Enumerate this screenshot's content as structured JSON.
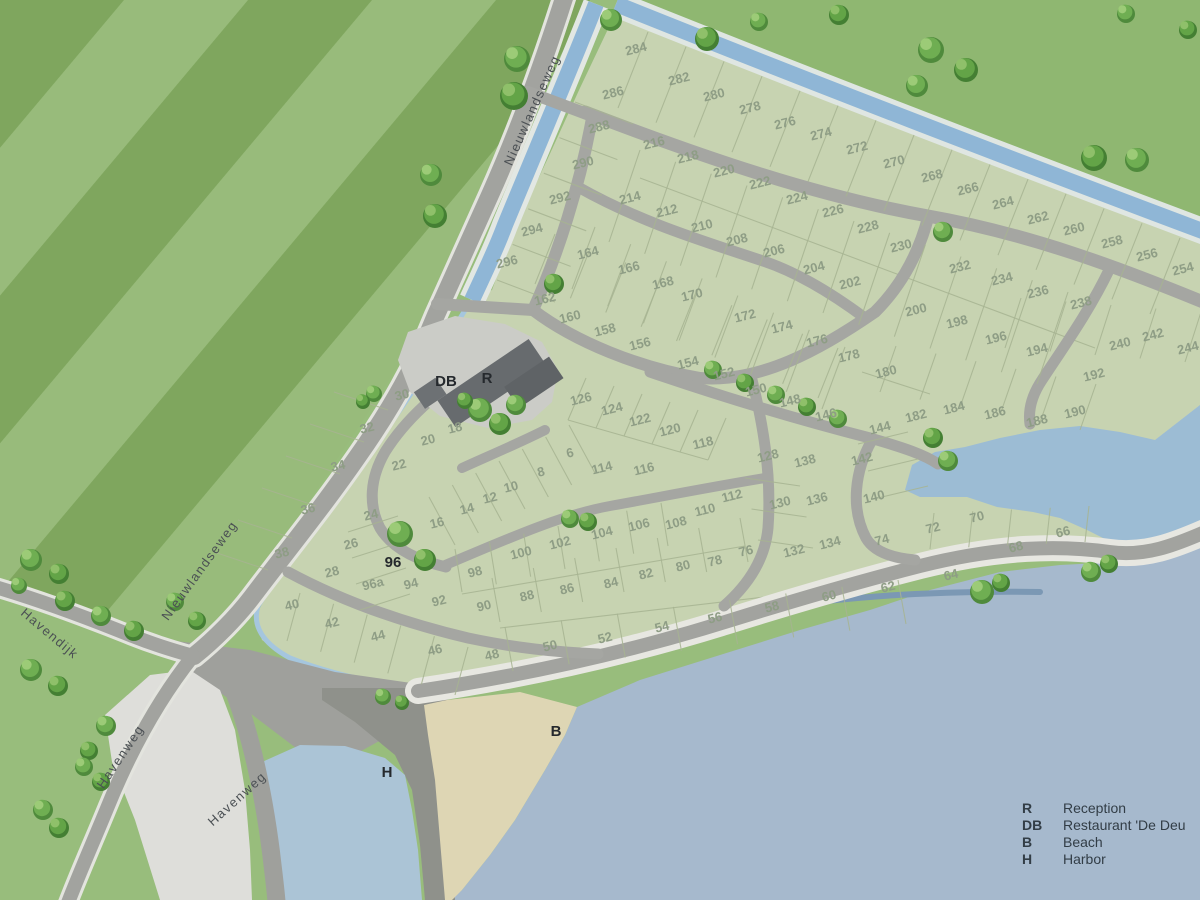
{
  "title": "Holiday park site map",
  "legend": {
    "items": [
      {
        "key": "R",
        "label": "Reception"
      },
      {
        "key": "DB",
        "label": "Restaurant 'De Deu"
      },
      {
        "key": "B",
        "label": "Beach"
      },
      {
        "key": "H",
        "label": "Harbor"
      }
    ]
  },
  "streets": {
    "nieuwlandseweg": "Nieuwlandseweg",
    "havendijk": "Havendijk",
    "havenweg": "Havenweg"
  },
  "markers": {
    "reception": {
      "key": "R"
    },
    "restaurant": {
      "key": "DB"
    },
    "beach": {
      "key": "B"
    },
    "harbor": {
      "key": "H"
    },
    "plot96": {
      "key": "96"
    }
  },
  "colors": {
    "park_green": "#c7d3b1",
    "field_green_light": "#98bb7b",
    "field_green_dark": "#7fa65e",
    "field_ne": "#8fb771",
    "water_sea": "#a6b9cd",
    "water_canal": "#8fb6d6",
    "water_pond": "#9cbcd4",
    "water_harbor": "#abc4d6",
    "road_gray": "#a2a39f",
    "quay_gray": "#8f918b",
    "beach_sand": "#ded6b4",
    "building_gray": "#65696c",
    "plot_number_color": "#8e9d85"
  },
  "plots": [
    [
      "284",
      637,
      53
    ],
    [
      "282",
      680,
      83
    ],
    [
      "280",
      715,
      99
    ],
    [
      "278",
      751,
      112
    ],
    [
      "276",
      786,
      127
    ],
    [
      "274",
      822,
      138
    ],
    [
      "272",
      858,
      152
    ],
    [
      "270",
      895,
      166
    ],
    [
      "268",
      933,
      180
    ],
    [
      "266",
      969,
      193
    ],
    [
      "264",
      1004,
      207
    ],
    [
      "262",
      1039,
      222
    ],
    [
      "260",
      1075,
      233
    ],
    [
      "258",
      1113,
      246
    ],
    [
      "256",
      1148,
      259
    ],
    [
      "254",
      1184,
      273
    ],
    [
      "286",
      614,
      97
    ],
    [
      "288",
      600,
      131
    ],
    [
      "290",
      584,
      167
    ],
    [
      "292",
      561,
      202
    ],
    [
      "294",
      533,
      234
    ],
    [
      "296",
      508,
      266
    ],
    [
      "216",
      655,
      147
    ],
    [
      "218",
      689,
      161
    ],
    [
      "220",
      725,
      175
    ],
    [
      "222",
      761,
      187
    ],
    [
      "224",
      798,
      202
    ],
    [
      "226",
      834,
      215
    ],
    [
      "228",
      869,
      231
    ],
    [
      "230",
      902,
      250
    ],
    [
      "232",
      961,
      271
    ],
    [
      "234",
      1003,
      283
    ],
    [
      "236",
      1039,
      296
    ],
    [
      "238",
      1082,
      307
    ],
    [
      "214",
      631,
      202
    ],
    [
      "212",
      668,
      215
    ],
    [
      "210",
      703,
      230
    ],
    [
      "208",
      738,
      244
    ],
    [
      "206",
      775,
      255
    ],
    [
      "204",
      815,
      272
    ],
    [
      "202",
      851,
      287
    ],
    [
      "200",
      917,
      314
    ],
    [
      "198",
      958,
      326
    ],
    [
      "196",
      997,
      342
    ],
    [
      "194",
      1038,
      354
    ],
    [
      "240",
      1121,
      348
    ],
    [
      "242",
      1154,
      339
    ],
    [
      "244",
      1189,
      352
    ],
    [
      "192",
      1095,
      379
    ],
    [
      "190",
      1076,
      416
    ],
    [
      "188",
      1038,
      425
    ],
    [
      "186",
      996,
      417
    ],
    [
      "184",
      955,
      412
    ],
    [
      "182",
      917,
      420
    ],
    [
      "180",
      887,
      376
    ],
    [
      "164",
      589,
      257
    ],
    [
      "166",
      630,
      272
    ],
    [
      "168",
      664,
      287
    ],
    [
      "170",
      693,
      299
    ],
    [
      "172",
      746,
      320
    ],
    [
      "174",
      783,
      331
    ],
    [
      "176",
      818,
      345
    ],
    [
      "178",
      850,
      360
    ],
    [
      "162",
      546,
      303
    ],
    [
      "160",
      571,
      321
    ],
    [
      "158",
      606,
      334
    ],
    [
      "156",
      641,
      348
    ],
    [
      "154",
      689,
      367
    ],
    [
      "152",
      725,
      378
    ],
    [
      "150",
      757,
      394
    ],
    [
      "148",
      791,
      405
    ],
    [
      "146",
      827,
      419
    ],
    [
      "144",
      881,
      432
    ],
    [
      "142",
      863,
      463
    ],
    [
      "140",
      875,
      501
    ],
    [
      "126",
      582,
      403
    ],
    [
      "124",
      613,
      413
    ],
    [
      "122",
      641,
      424
    ],
    [
      "120",
      671,
      434
    ],
    [
      "118",
      704,
      447
    ],
    [
      "6",
      571,
      457
    ],
    [
      "8",
      542,
      476
    ],
    [
      "10",
      512,
      491
    ],
    [
      "12",
      491,
      502
    ],
    [
      "14",
      468,
      513
    ],
    [
      "16",
      438,
      527
    ],
    [
      "18",
      456,
      432
    ],
    [
      "20",
      429,
      444
    ],
    [
      "22",
      400,
      469
    ],
    [
      "24",
      372,
      519
    ],
    [
      "26",
      352,
      548
    ],
    [
      "28",
      333,
      576
    ],
    [
      "30",
      403,
      399
    ],
    [
      "32",
      368,
      432
    ],
    [
      "34",
      339,
      470
    ],
    [
      "36",
      309,
      513
    ],
    [
      "38",
      283,
      557
    ],
    [
      "40",
      293,
      609
    ],
    [
      "42",
      333,
      627
    ],
    [
      "44",
      379,
      640
    ],
    [
      "46",
      436,
      654
    ],
    [
      "48",
      493,
      659
    ],
    [
      "50",
      551,
      650
    ],
    [
      "52",
      606,
      642
    ],
    [
      "54",
      663,
      631
    ],
    [
      "56",
      716,
      622
    ],
    [
      "58",
      773,
      611
    ],
    [
      "60",
      830,
      600
    ],
    [
      "62",
      889,
      591
    ],
    [
      "64",
      952,
      579
    ],
    [
      "66",
      1064,
      536
    ],
    [
      "68",
      1017,
      551
    ],
    [
      "70",
      978,
      521
    ],
    [
      "72",
      934,
      532
    ],
    [
      "74",
      883,
      544
    ],
    [
      "76",
      747,
      555
    ],
    [
      "78",
      716,
      565
    ],
    [
      "80",
      684,
      570
    ],
    [
      "82",
      647,
      578
    ],
    [
      "84",
      612,
      587
    ],
    [
      "86",
      568,
      593
    ],
    [
      "88",
      528,
      600
    ],
    [
      "90",
      485,
      610
    ],
    [
      "92",
      440,
      605
    ],
    [
      "94",
      412,
      588
    ],
    [
      "96a",
      374,
      588
    ],
    [
      "98",
      476,
      576
    ],
    [
      "100",
      522,
      557
    ],
    [
      "102",
      561,
      547
    ],
    [
      "104",
      603,
      537
    ],
    [
      "106",
      640,
      529
    ],
    [
      "108",
      677,
      527
    ],
    [
      "110",
      706,
      514
    ],
    [
      "112",
      733,
      500
    ],
    [
      "114",
      603,
      472
    ],
    [
      "116",
      645,
      473
    ],
    [
      "128",
      769,
      460
    ],
    [
      "130",
      781,
      507
    ],
    [
      "132",
      795,
      555
    ],
    [
      "134",
      831,
      547
    ],
    [
      "136",
      818,
      503
    ],
    [
      "138",
      806,
      465
    ]
  ],
  "map": {
    "trees": [
      [
        516,
        57,
        13,
        0
      ],
      [
        513,
        94,
        14,
        1
      ],
      [
        430,
        173,
        11,
        0
      ],
      [
        434,
        214,
        12,
        1
      ],
      [
        610,
        18,
        11,
        0
      ],
      [
        706,
        37,
        12,
        1
      ],
      [
        758,
        20,
        9,
        0
      ],
      [
        838,
        13,
        10,
        1
      ],
      [
        930,
        48,
        13,
        0
      ],
      [
        965,
        68,
        12,
        1
      ],
      [
        916,
        84,
        11,
        0
      ],
      [
        1093,
        156,
        13,
        1
      ],
      [
        1136,
        158,
        12,
        0
      ],
      [
        1187,
        28,
        9,
        1
      ],
      [
        1125,
        12,
        9,
        0
      ],
      [
        942,
        230,
        10,
        0
      ],
      [
        373,
        392,
        8,
        0
      ],
      [
        362,
        400,
        7,
        1
      ],
      [
        553,
        282,
        10,
        1
      ],
      [
        712,
        368,
        9,
        0
      ],
      [
        744,
        381,
        9,
        1
      ],
      [
        775,
        393,
        9,
        0
      ],
      [
        806,
        405,
        9,
        1
      ],
      [
        837,
        417,
        9,
        0
      ],
      [
        932,
        436,
        10,
        1
      ],
      [
        947,
        459,
        10,
        0
      ],
      [
        399,
        532,
        13,
        0
      ],
      [
        424,
        558,
        11,
        1
      ],
      [
        479,
        408,
        12,
        0
      ],
      [
        499,
        422,
        11,
        1
      ],
      [
        515,
        403,
        10,
        0
      ],
      [
        464,
        399,
        8,
        1
      ],
      [
        569,
        517,
        9,
        0
      ],
      [
        587,
        520,
        9,
        1
      ],
      [
        981,
        590,
        12,
        0
      ],
      [
        1000,
        581,
        9,
        1
      ],
      [
        1090,
        570,
        10,
        0
      ],
      [
        1108,
        562,
        9,
        1
      ],
      [
        382,
        695,
        8,
        0
      ],
      [
        401,
        701,
        7,
        1
      ],
      [
        30,
        558,
        11,
        0
      ],
      [
        58,
        572,
        10,
        1
      ],
      [
        18,
        584,
        8,
        0
      ],
      [
        64,
        599,
        10,
        1
      ],
      [
        100,
        614,
        10,
        0
      ],
      [
        133,
        629,
        10,
        1
      ],
      [
        30,
        668,
        11,
        0
      ],
      [
        57,
        684,
        10,
        1
      ],
      [
        105,
        724,
        10,
        0
      ],
      [
        88,
        749,
        9,
        1
      ],
      [
        83,
        765,
        9,
        0
      ],
      [
        100,
        780,
        9,
        1
      ],
      [
        42,
        808,
        10,
        0
      ],
      [
        58,
        826,
        10,
        1
      ],
      [
        174,
        600,
        9,
        0
      ],
      [
        196,
        619,
        9,
        1
      ]
    ]
  }
}
